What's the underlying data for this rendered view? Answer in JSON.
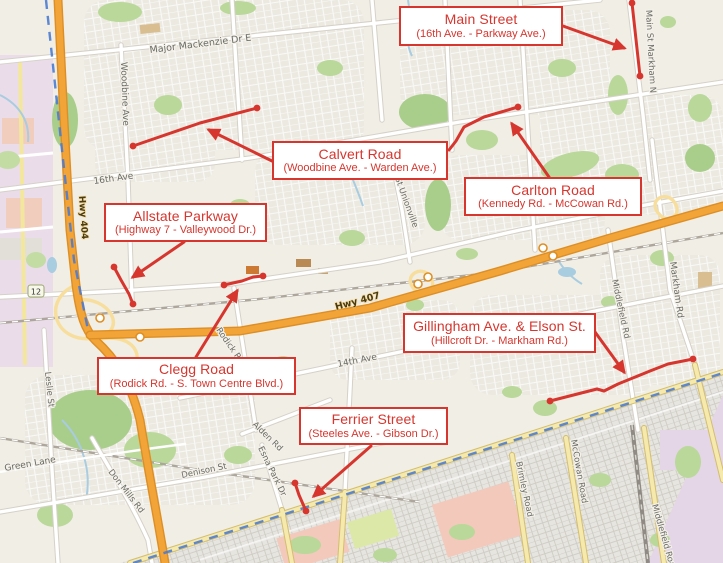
{
  "annotations": [
    {
      "id": "main-street",
      "title": "Main Street",
      "subtitle": "(16th Ave. - Parkway Ave.)"
    },
    {
      "id": "calvert-road",
      "title": "Calvert Road",
      "subtitle": "(Woodbine Ave. - Warden Ave.)"
    },
    {
      "id": "carlton-road",
      "title": "Carlton Road",
      "subtitle": "(Kennedy Rd. - McCowan Rd.)"
    },
    {
      "id": "allstate-parkway",
      "title": "Allstate Parkway",
      "subtitle": "(Highway 7 - Valleywood Dr.)"
    },
    {
      "id": "clegg-road",
      "title": "Clegg Road",
      "subtitle": "(Rodick Rd. - S. Town Centre Blvd.)"
    },
    {
      "id": "gillingham-elson",
      "title": "Gillingham Ave. & Elson St.",
      "subtitle": "(Hillcroft Dr. - Markham Rd.)"
    },
    {
      "id": "ferrier-street",
      "title": "Ferrier Street",
      "subtitle": "(Steeles Ave. - Gibson Dr.)"
    }
  ],
  "map_labels": {
    "major_mackenzie": "Major Mackenzie Dr E",
    "woodbine": "Woodbine Ave",
    "sixteenth_ave": "16th Ave",
    "hwy404": "Hwy 404",
    "hwy407": "Hwy 407",
    "shield12": "12",
    "leslie": "Leslie St",
    "green_lane": "Green Lane",
    "don_mills": "Don Mills Rd",
    "denison": "Denison St",
    "esna_park": "Esna Park Dr",
    "alden": "Alden Rd",
    "fourteenth_ave": "14th Ave",
    "rodick": "Rodick Rd",
    "st_unionville": "St Unionville",
    "main_st_markham": "Main St Markham N",
    "middlefield": "Middlefield Rd",
    "markham_rd": "Markham Rd",
    "brimley_road": "Brimley Road",
    "mccowan_road": "McCowan Road",
    "middlefield_road": "Middlefield Road"
  },
  "colors": {
    "annotation_red": "#D6362E",
    "highway_orange": "#F2A438",
    "highway_ramp_yellow": "#F8DE9C",
    "boundary_blue": "#4B7BD0",
    "park_green": "#B9D89A",
    "land_beige": "#F1EEE6",
    "urban_pink": "#EBDCEA",
    "toronto_salmon": "#F2C9BB",
    "yellow_road": "#F5E9AE",
    "water_blue": "#A8CCE0"
  }
}
